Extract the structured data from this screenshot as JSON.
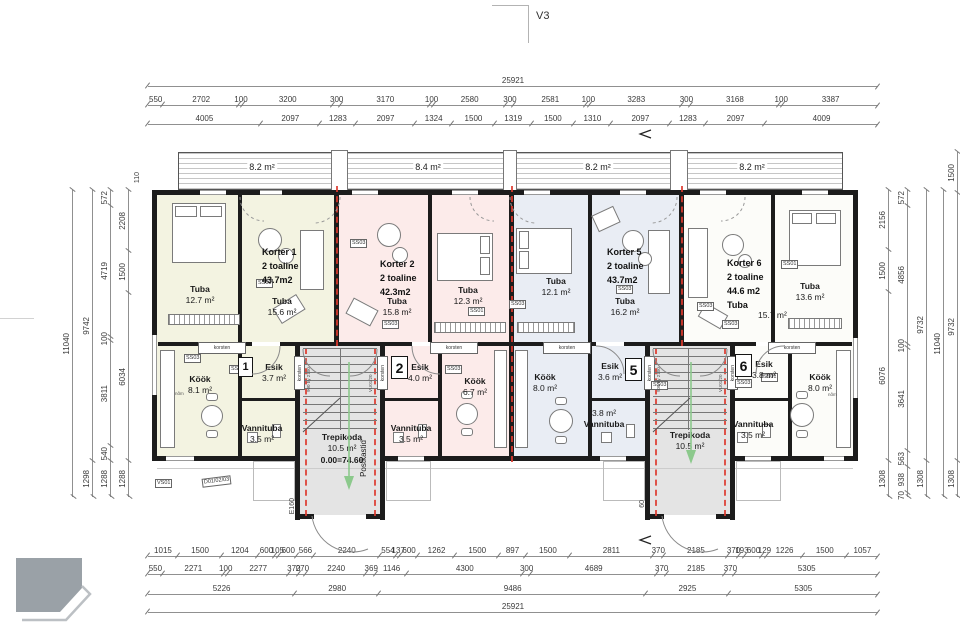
{
  "sheet": {
    "view_label": "V3",
    "page_number": "24"
  },
  "balconies": [
    {
      "area": "8.2 m²"
    },
    {
      "area": "8.4 m²"
    },
    {
      "area": "8.2 m²"
    },
    {
      "area": "8.2 m²"
    }
  ],
  "apartments": {
    "k1": {
      "badge": "1",
      "name": "Korter 1",
      "type": "2 toaline",
      "area": "43.7m2"
    },
    "k2": {
      "badge": "2",
      "name": "Korter 2",
      "type": "2 toaline",
      "area": "42.3m2"
    },
    "k5": {
      "badge": "5",
      "name": "Korter 5",
      "type": "2 toaline",
      "area": "43.7m2"
    },
    "k6": {
      "badge": "6",
      "name": "Korter 6",
      "type": "2 toaline",
      "area": "44.6 m2"
    }
  },
  "rooms": {
    "tuba_a": {
      "name": "Tuba",
      "area": "12.7 m²"
    },
    "tuba_k1": {
      "name": "Tuba",
      "area": "15.6 m²"
    },
    "tuba_k2": {
      "name": "Tuba",
      "area": "15.8 m²"
    },
    "tuba_b": {
      "name": "Tuba",
      "area": "12.3 m²"
    },
    "tuba_c": {
      "name": "Tuba",
      "area": "12.1 m²"
    },
    "tuba_k5": {
      "name": "Tuba",
      "area": "16.2 m²"
    },
    "tuba_k6": {
      "name": "Tuba",
      "area": "15.7 m²"
    },
    "tuba_d": {
      "name": "Tuba",
      "area": "13.6 m²"
    },
    "kook_k1": {
      "name": "Köök",
      "area": "8.1 m²"
    },
    "kook_k2": {
      "name": "Köök",
      "area": "6.7 m²"
    },
    "kook_k5": {
      "name": "Köök",
      "area": "8.0 m²"
    },
    "kook_k6": {
      "name": "Köök",
      "area": "8.0 m²"
    },
    "esik_k1": {
      "name": "Esik",
      "area": "3.7 m²"
    },
    "esik_k2": {
      "name": "Esik",
      "area": "4.0 m²"
    },
    "esik_k5": {
      "name": "Esik",
      "area": "3.6 m²"
    },
    "esik_k6": {
      "name": "Esik",
      "area": "3.8 m²"
    },
    "vann_k1": {
      "name": "Vannituba",
      "area": "3.5 m²"
    },
    "vann_k2": {
      "name": "Vannituba",
      "area": "3.5 m²"
    },
    "vann_k5": {
      "name": "Vannituba",
      "area": "3.8 m²"
    },
    "vann_k6": {
      "name": "Vannituba",
      "area": "3.5 m²"
    }
  },
  "stairwells": {
    "west": {
      "name": "Trepikoda",
      "area": "10.5 m²",
      "level": "0.00=74.60",
      "mailboxes": "Postkastid",
      "entry_tag": "E160"
    },
    "east": {
      "name": "Trepikoda",
      "area": "10.5 m²",
      "entry_tag": "60"
    }
  },
  "tags": {
    "chimney": "korsten",
    "ss03": "SS03",
    "ss01": "SS01",
    "vs01": "VS01",
    "door_group": "D01/02/03",
    "door_size": "900 by 2100",
    "door_code": "VU01/20",
    "misc": "nõm",
    "wall_110": "110"
  },
  "dimensions": {
    "top": {
      "total": "25921",
      "row2": [
        550,
        2702,
        100,
        3200,
        300,
        3170,
        100,
        2580,
        300,
        2581,
        100,
        3283,
        300,
        3168,
        100,
        3387
      ],
      "row3": [
        4005,
        2097,
        1283,
        2097,
        1324,
        1500,
        1319,
        1500,
        1310,
        2097,
        1283,
        2097,
        4009
      ]
    },
    "bottom": {
      "rowA": [
        1015,
        1500,
        1204,
        600,
        105,
        600,
        566,
        2240,
        554,
        137,
        600,
        1262,
        1500,
        897,
        1500,
        2811,
        370,
        2185,
        370,
        193,
        600,
        129,
        1226,
        1500,
        1057
      ],
      "rowB": [
        550,
        2271,
        100,
        2277,
        370,
        270,
        2240,
        369,
        1146,
        4300,
        300,
        4689,
        370,
        2185,
        370,
        5305
      ],
      "rowC": [
        5226,
        2980,
        9486,
        2925,
        5305
      ],
      "total": "25921"
    },
    "left": {
      "col1": [
        11040
      ],
      "col2": [
        9742,
        1298
      ],
      "col3": [
        572,
        4719,
        100,
        3811,
        540,
        1288
      ],
      "col4": [
        2208,
        1500,
        6034,
        1288
      ]
    },
    "right": {
      "col1": [
        2156,
        1500,
        6076,
        1308
      ],
      "col2": [
        572,
        4856,
        100,
        3641,
        563,
        938,
        70
      ],
      "col3": [
        9732,
        1308
      ],
      "col4": [
        11040
      ],
      "col5": [
        1500,
        9732,
        1308
      ]
    }
  }
}
